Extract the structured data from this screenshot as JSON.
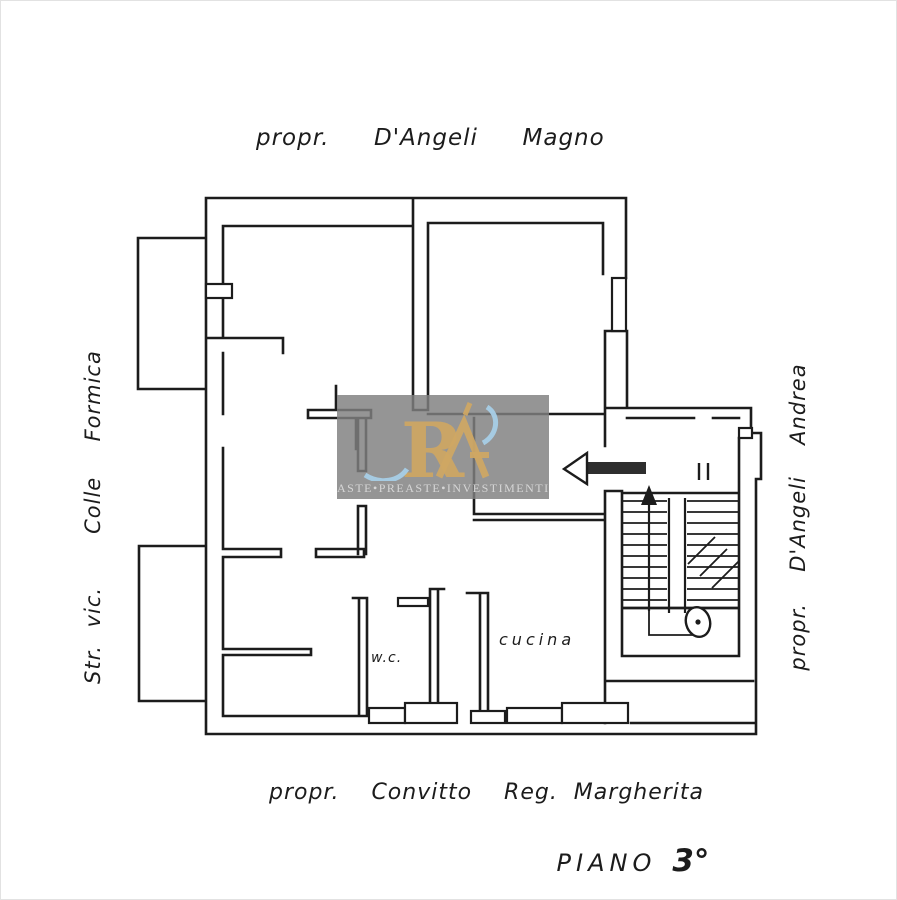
{
  "page": {
    "background": "#ffffff",
    "ink": "#1c1c1c",
    "frame": "#e2e2e2"
  },
  "labels": {
    "top_owner": "propr.  D'Angeli  Magno",
    "left_street": "Str. vic.   Colle  Formica",
    "right_owner": "propr.  D'Angeli  Andrea",
    "bottom_owner": "propr.  Convitto  Reg. Margherita",
    "floor_word": "PIANO",
    "floor_number": "3°"
  },
  "rooms": {
    "wc": "w.c.",
    "kitchen": "cucina"
  },
  "icons": {
    "entry_arrow": "left-arrow",
    "stair_direction": "up-arrow",
    "stair_break": "diagonal-break-marks",
    "door_marks": "double-tick-door-marks"
  },
  "watermark": {
    "monogram": "R",
    "caption": "ASTE•PREASTE•INVESTIMENTI",
    "panel_color": "#7f7f7f",
    "gold": "#cfa763",
    "blue": "#a6cde6",
    "text_color": "#d6d6d6"
  }
}
